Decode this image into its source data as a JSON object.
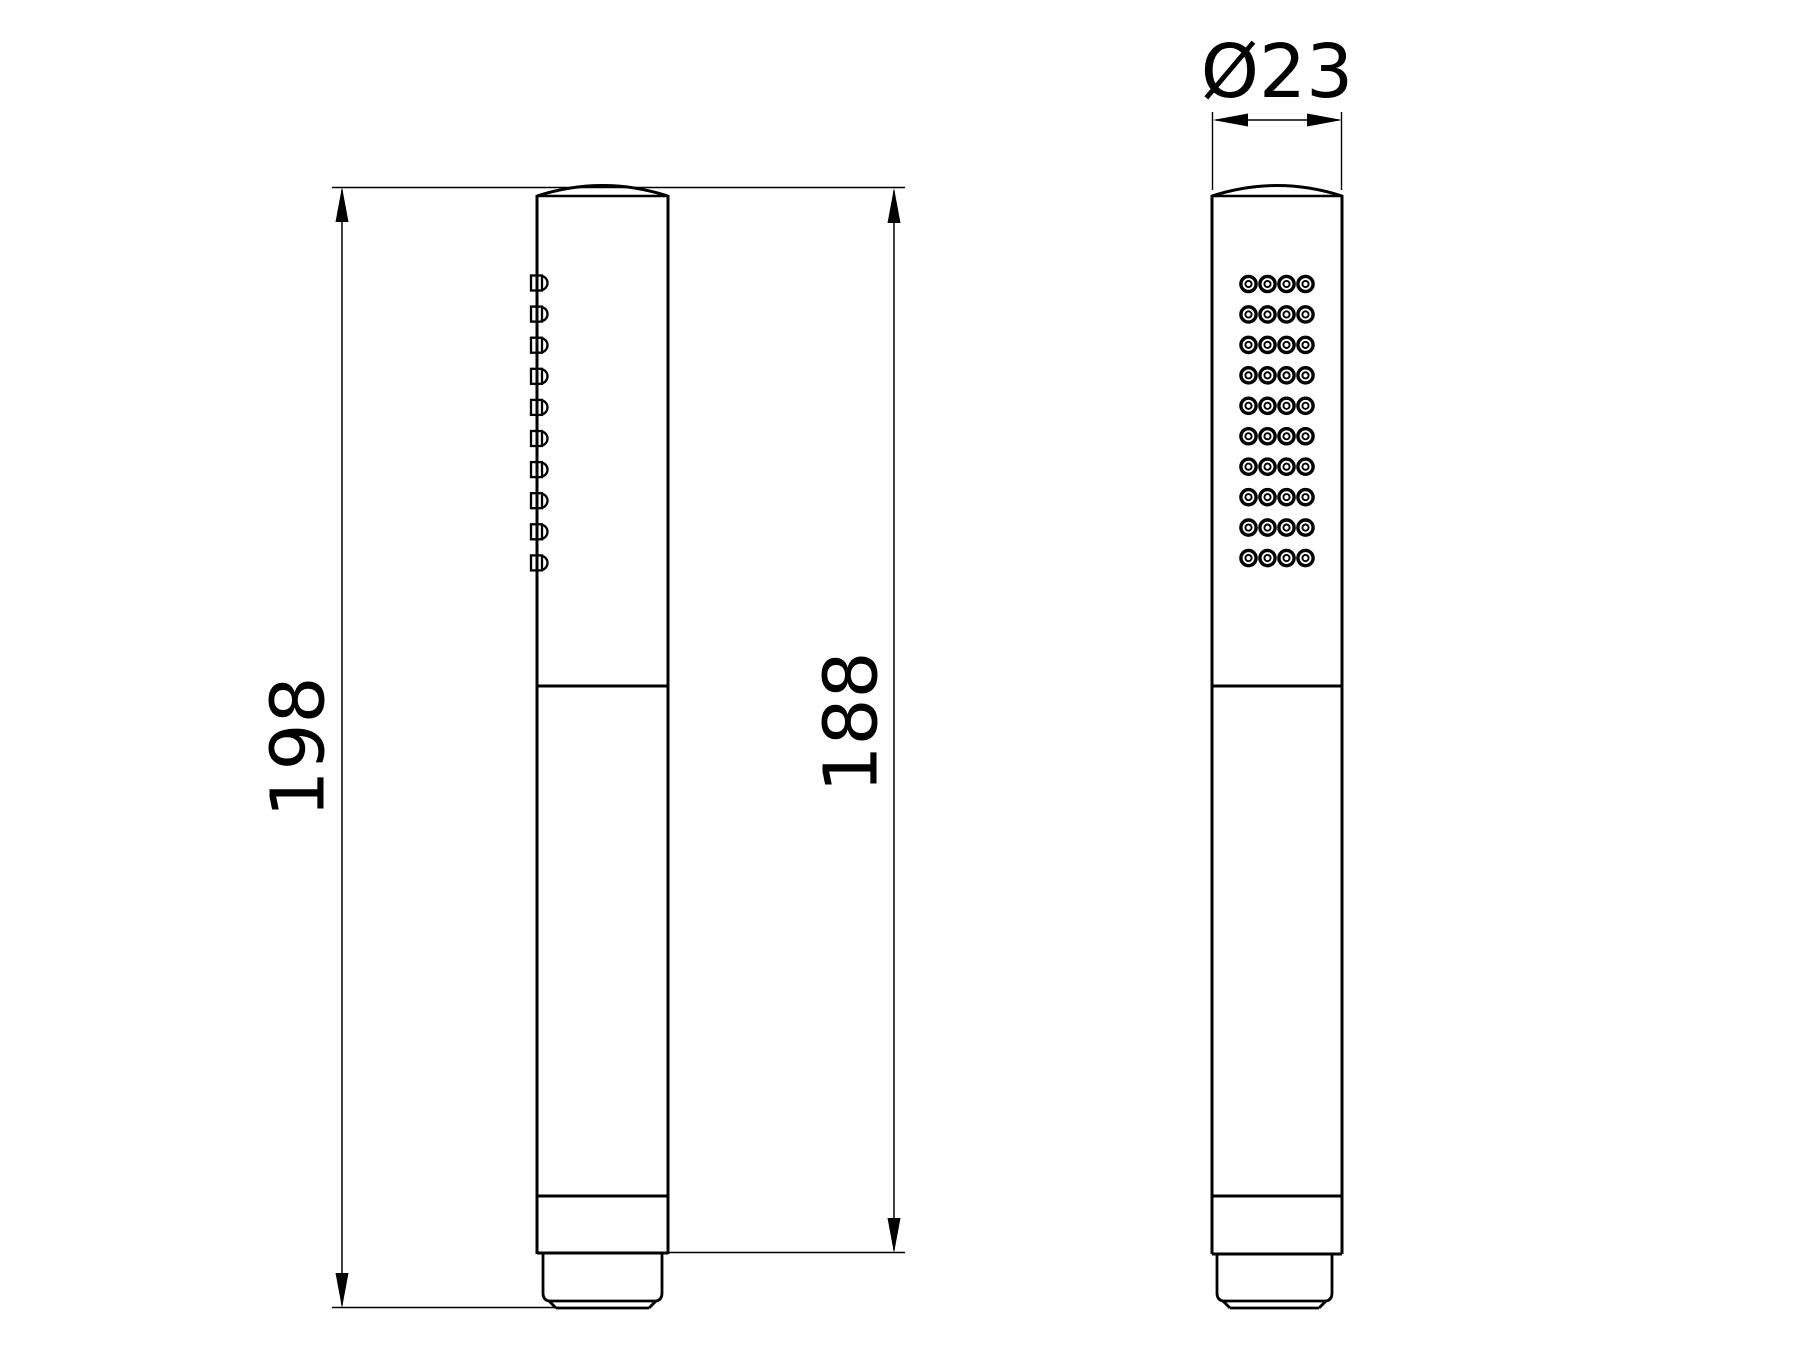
{
  "drawing": {
    "title": "handheld-shower-technical-drawing",
    "colors": {
      "line": "#000000",
      "background": "#ffffff"
    },
    "dimensions": {
      "overall_length": {
        "label": "198"
      },
      "body_length": {
        "label": "188"
      },
      "diameter": {
        "label": "Ø23"
      }
    },
    "side_view": {
      "nozzle_count": 10
    },
    "front_view": {
      "nozzle_rows": 10,
      "nozzle_cols": 4
    }
  }
}
